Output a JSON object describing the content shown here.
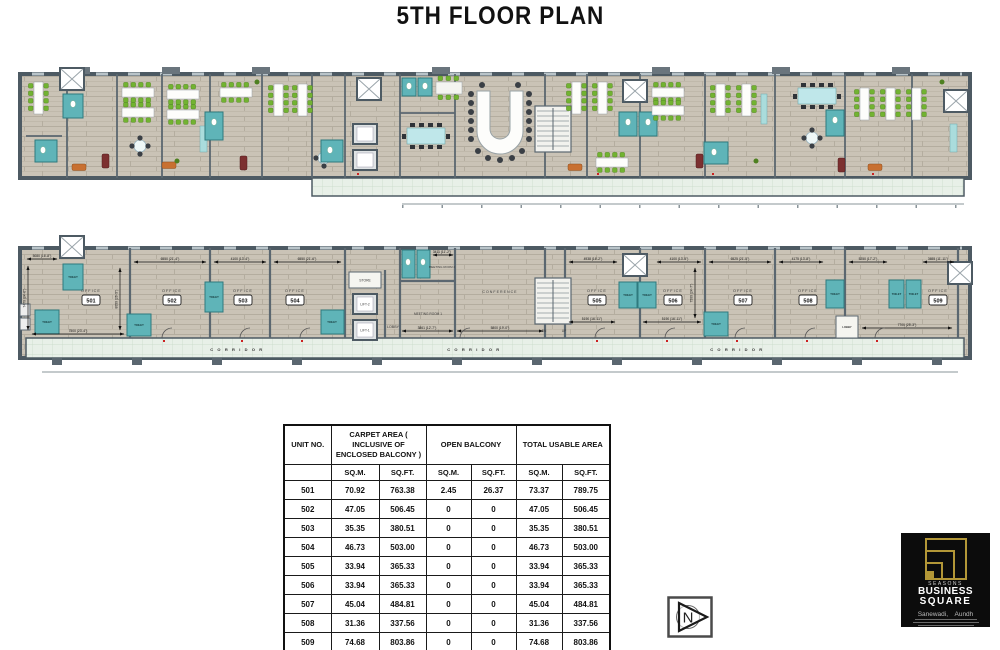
{
  "header": {
    "title": "5TH FLOOR PLAN"
  },
  "plan": {
    "units": [
      {
        "name": "OFFICE",
        "no": "501"
      },
      {
        "name": "OFFICE",
        "no": "502"
      },
      {
        "name": "OFFICE",
        "no": "503"
      },
      {
        "name": "OFFICE",
        "no": "504"
      },
      {
        "name": "OFFICE",
        "no": "505"
      },
      {
        "name": "OFFICE",
        "no": "506"
      },
      {
        "name": "OFFICE",
        "no": "507"
      },
      {
        "name": "OFFICE",
        "no": "508"
      },
      {
        "name": "OFFICE",
        "no": "509"
      }
    ],
    "labels": {
      "toilet": "TOILET",
      "corridor": "C O R R I D O R",
      "lobby": "LOBBY",
      "store": "STORE",
      "lift1": "LIFT-1",
      "lift2": "LIFT-2",
      "meeting1": "MEETING ROOM 1",
      "meeting2": "MEETING ROOM 2",
      "conference": "CONFERENCE",
      "dn": "DN",
      "up": "UP"
    },
    "dims": [
      "5080 (16'-8\")",
      "7500 (23'-4\")",
      "6550 (21'-4\")",
      "4100 (13'-4\")",
      "6550 (21'-6\")",
      "3411 (11'-2\")",
      "3861 (12'-7\")",
      "5800 (19'-0\")",
      "4938 (16'-2\")",
      "4100 (13'-5\")",
      "5190 (16'-11\")",
      "5190 (16'-11\")",
      "6525 (21'-5\")",
      "4175 (13'-8\")",
      "5250 (17'-2\")",
      "3655 (11'-11\")",
      "7700 (25'-3\")",
      "7470 (24'-6\")",
      "8050 (26'-5\")",
      "7500 (24'-7\")"
    ],
    "colors": {
      "wall": "#4d5a63",
      "floor": "#cac3b6",
      "toilet_teal": "#5fb4b8",
      "corridor_mint": "#e8f0e8",
      "chair_green": "#72b331",
      "accent_orange": "#c87031",
      "accent_maroon": "#7c3030"
    }
  },
  "table": {
    "headers": {
      "unit": "UNIT NO.",
      "carpet": "CARPET AREA ( INCLUSIVE OF ENCLOSED BALCONY )",
      "balcony": "OPEN BALCONY",
      "total": "TOTAL USABLE AREA",
      "sqm": "SQ.M.",
      "sqft": "SQ.FT.",
      "blank": ""
    },
    "rows": [
      {
        "u": "501",
        "c1": "70.92",
        "c2": "763.38",
        "b1": "2.45",
        "b2": "26.37",
        "t1": "73.37",
        "t2": "789.75"
      },
      {
        "u": "502",
        "c1": "47.05",
        "c2": "506.45",
        "b1": "0",
        "b2": "0",
        "t1": "47.05",
        "t2": "506.45"
      },
      {
        "u": "503",
        "c1": "35.35",
        "c2": "380.51",
        "b1": "0",
        "b2": "0",
        "t1": "35.35",
        "t2": "380.51"
      },
      {
        "u": "504",
        "c1": "46.73",
        "c2": "503.00",
        "b1": "0",
        "b2": "0",
        "t1": "46.73",
        "t2": "503.00"
      },
      {
        "u": "505",
        "c1": "33.94",
        "c2": "365.33",
        "b1": "0",
        "b2": "0",
        "t1": "33.94",
        "t2": "365.33"
      },
      {
        "u": "506",
        "c1": "33.94",
        "c2": "365.33",
        "b1": "0",
        "b2": "0",
        "t1": "33.94",
        "t2": "365.33"
      },
      {
        "u": "507",
        "c1": "45.04",
        "c2": "484.81",
        "b1": "0",
        "b2": "0",
        "t1": "45.04",
        "t2": "484.81"
      },
      {
        "u": "508",
        "c1": "31.36",
        "c2": "337.56",
        "b1": "0",
        "b2": "0",
        "t1": "31.36",
        "t2": "337.56"
      },
      {
        "u": "509",
        "c1": "74.68",
        "c2": "803.86",
        "b1": "0",
        "b2": "0",
        "t1": "74.68",
        "t2": "803.86"
      }
    ]
  },
  "compass": {
    "letter": "N"
  },
  "logo": {
    "brand_top": "SEASONS",
    "brand_mid": "BUSINESS",
    "brand_bottom": "SQUARE",
    "location": "Sanewadi,  Aundh"
  }
}
